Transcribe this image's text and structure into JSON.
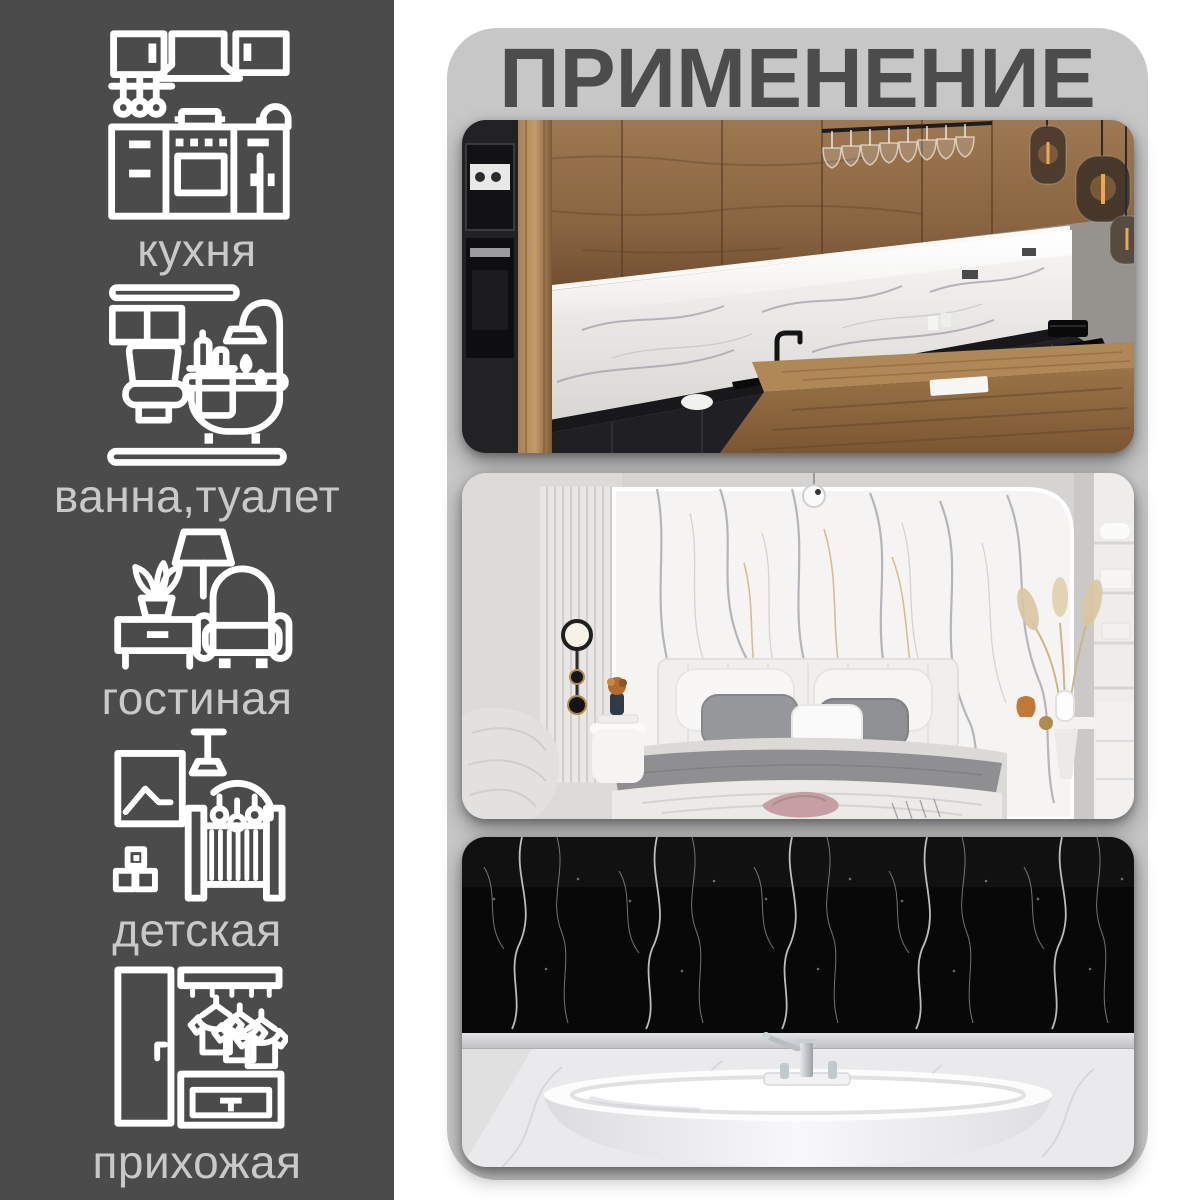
{
  "title": "ПРИМЕНЕНИЕ",
  "colors": {
    "page_bg": "#ffffff",
    "sidebar_bg": "#4b4b4b",
    "panel_bg": "#c7c7c7",
    "title": "#4c4c4c",
    "icon": "#ffffff",
    "label": "#c9c9c9"
  },
  "sidebar": {
    "items": [
      {
        "id": "kitchen",
        "label": "кухня",
        "icon": "kitchen-cabinets-icon"
      },
      {
        "id": "bathroom",
        "label": "ванна,туалет",
        "icon": "bathtub-toilet-icon"
      },
      {
        "id": "living-room",
        "label": "гостиная",
        "icon": "armchair-lamp-icon"
      },
      {
        "id": "nursery",
        "label": "детская",
        "icon": "baby-crib-icon"
      },
      {
        "id": "hallway",
        "label": "прихожая",
        "icon": "wardrobe-hangers-icon"
      }
    ]
  },
  "photos": [
    {
      "id": "kitchen-photo",
      "subject": "kitchen with wood cabinets, white marble backsplash and black counters"
    },
    {
      "id": "bedroom-photo",
      "subject": "bedroom with white marble accent wall behind bed"
    },
    {
      "id": "bathroom-photo",
      "subject": "bathroom with black marble wall and white freestanding bathtub"
    }
  ]
}
